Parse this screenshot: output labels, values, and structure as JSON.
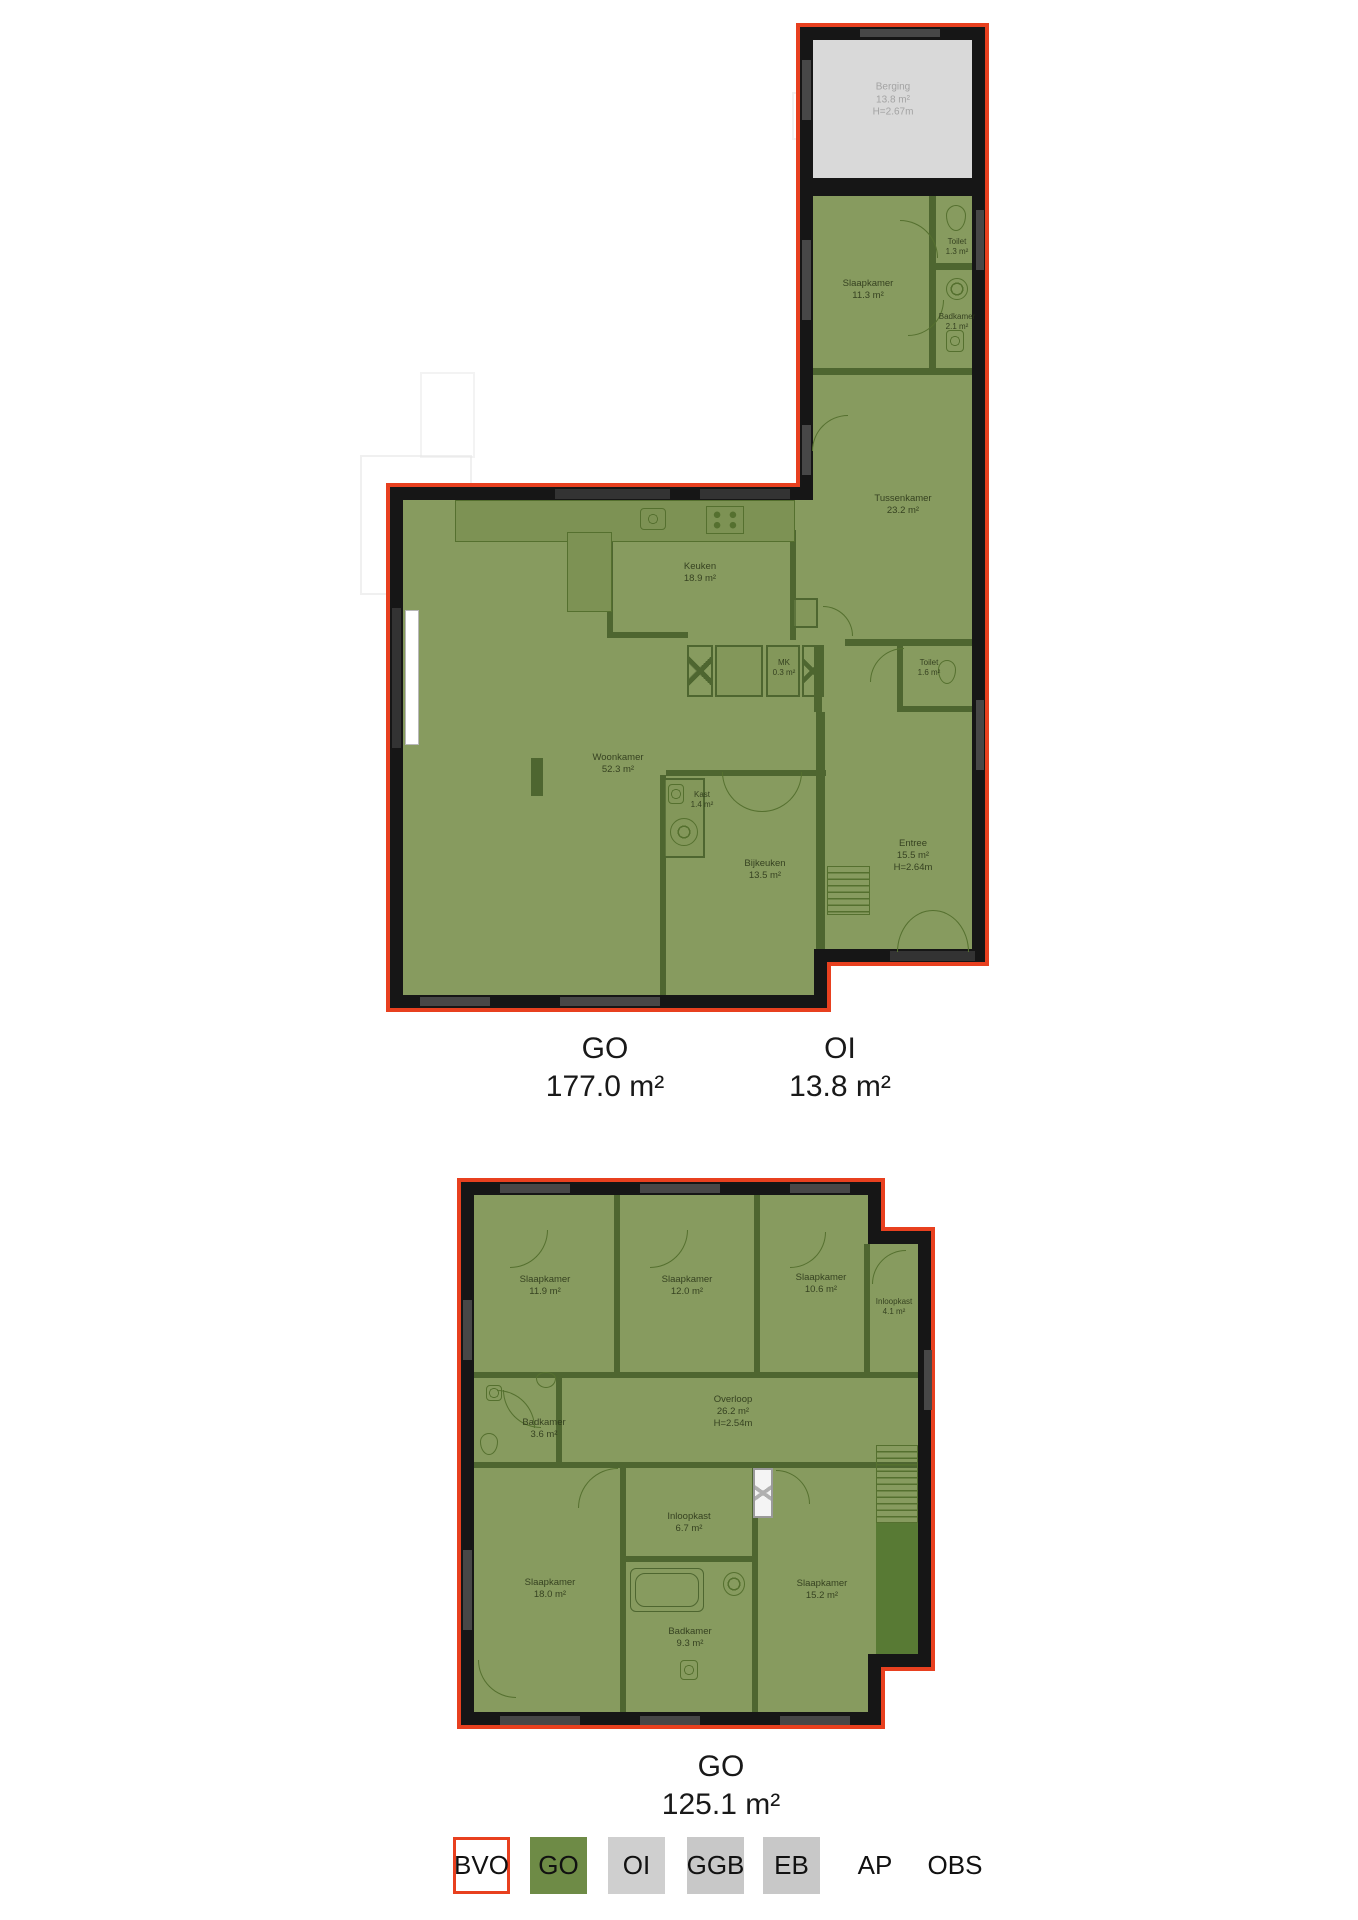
{
  "colors": {
    "outline_red": "#e8401f",
    "wall_black": "#161616",
    "room_green": "#879b5f",
    "interior_wall_green": "#4e6630",
    "oi_gray": "#d9d9d9",
    "legend_green": "#6e8b46",
    "legend_gray": "#c8c8c8"
  },
  "plan_top": {
    "rooms": [
      {
        "name": "Berging",
        "area": "13.8 m²",
        "height": "H=2.67m"
      },
      {
        "name": "Slaapkamer",
        "area": "11.3 m²"
      },
      {
        "name": "Toilet",
        "area": "1.3 m²"
      },
      {
        "name": "Badkamer",
        "area": "2.1 m²"
      },
      {
        "name": "Tussenkamer",
        "area": "23.2 m²"
      },
      {
        "name": "Keuken",
        "area": "18.9 m²"
      },
      {
        "name": "MK",
        "area": "0.3 m²"
      },
      {
        "name": "Toilet",
        "area": "1.6 m²"
      },
      {
        "name": "Woonkamer",
        "area": "52.3 m²"
      },
      {
        "name": "Kast",
        "area": "1.4 m²"
      },
      {
        "name": "Bijkeuken",
        "area": "13.5 m²"
      },
      {
        "name": "Entree",
        "area": "15.5 m²",
        "height": "H=2.64m"
      }
    ],
    "totals": [
      {
        "label": "GO",
        "value": "177.0 m²"
      },
      {
        "label": "OI",
        "value": "13.8 m²"
      }
    ]
  },
  "plan_bottom": {
    "rooms": [
      {
        "name": "Slaapkamer",
        "area": "11.9 m²"
      },
      {
        "name": "Slaapkamer",
        "area": "12.0 m²"
      },
      {
        "name": "Slaapkamer",
        "area": "10.6 m²"
      },
      {
        "name": "Inloopkast",
        "area": "4.1 m²"
      },
      {
        "name": "Badkamer",
        "area": "3.6 m²"
      },
      {
        "name": "Overloop",
        "area": "26.2 m²",
        "height": "H=2.54m"
      },
      {
        "name": "Slaapkamer",
        "area": "18.0 m²"
      },
      {
        "name": "Inloopkast",
        "area": "6.7 m²"
      },
      {
        "name": "Badkamer",
        "area": "9.3 m²"
      },
      {
        "name": "Slaapkamer",
        "area": "15.2 m²"
      }
    ],
    "totals": [
      {
        "label": "GO",
        "value": "125.1 m²"
      }
    ]
  },
  "legend": {
    "items": [
      {
        "label": "BVO"
      },
      {
        "label": "GO"
      },
      {
        "label": "OI"
      },
      {
        "label": "GGB"
      },
      {
        "label": "EB"
      },
      {
        "label": "AP"
      },
      {
        "label": "OBS"
      }
    ]
  }
}
